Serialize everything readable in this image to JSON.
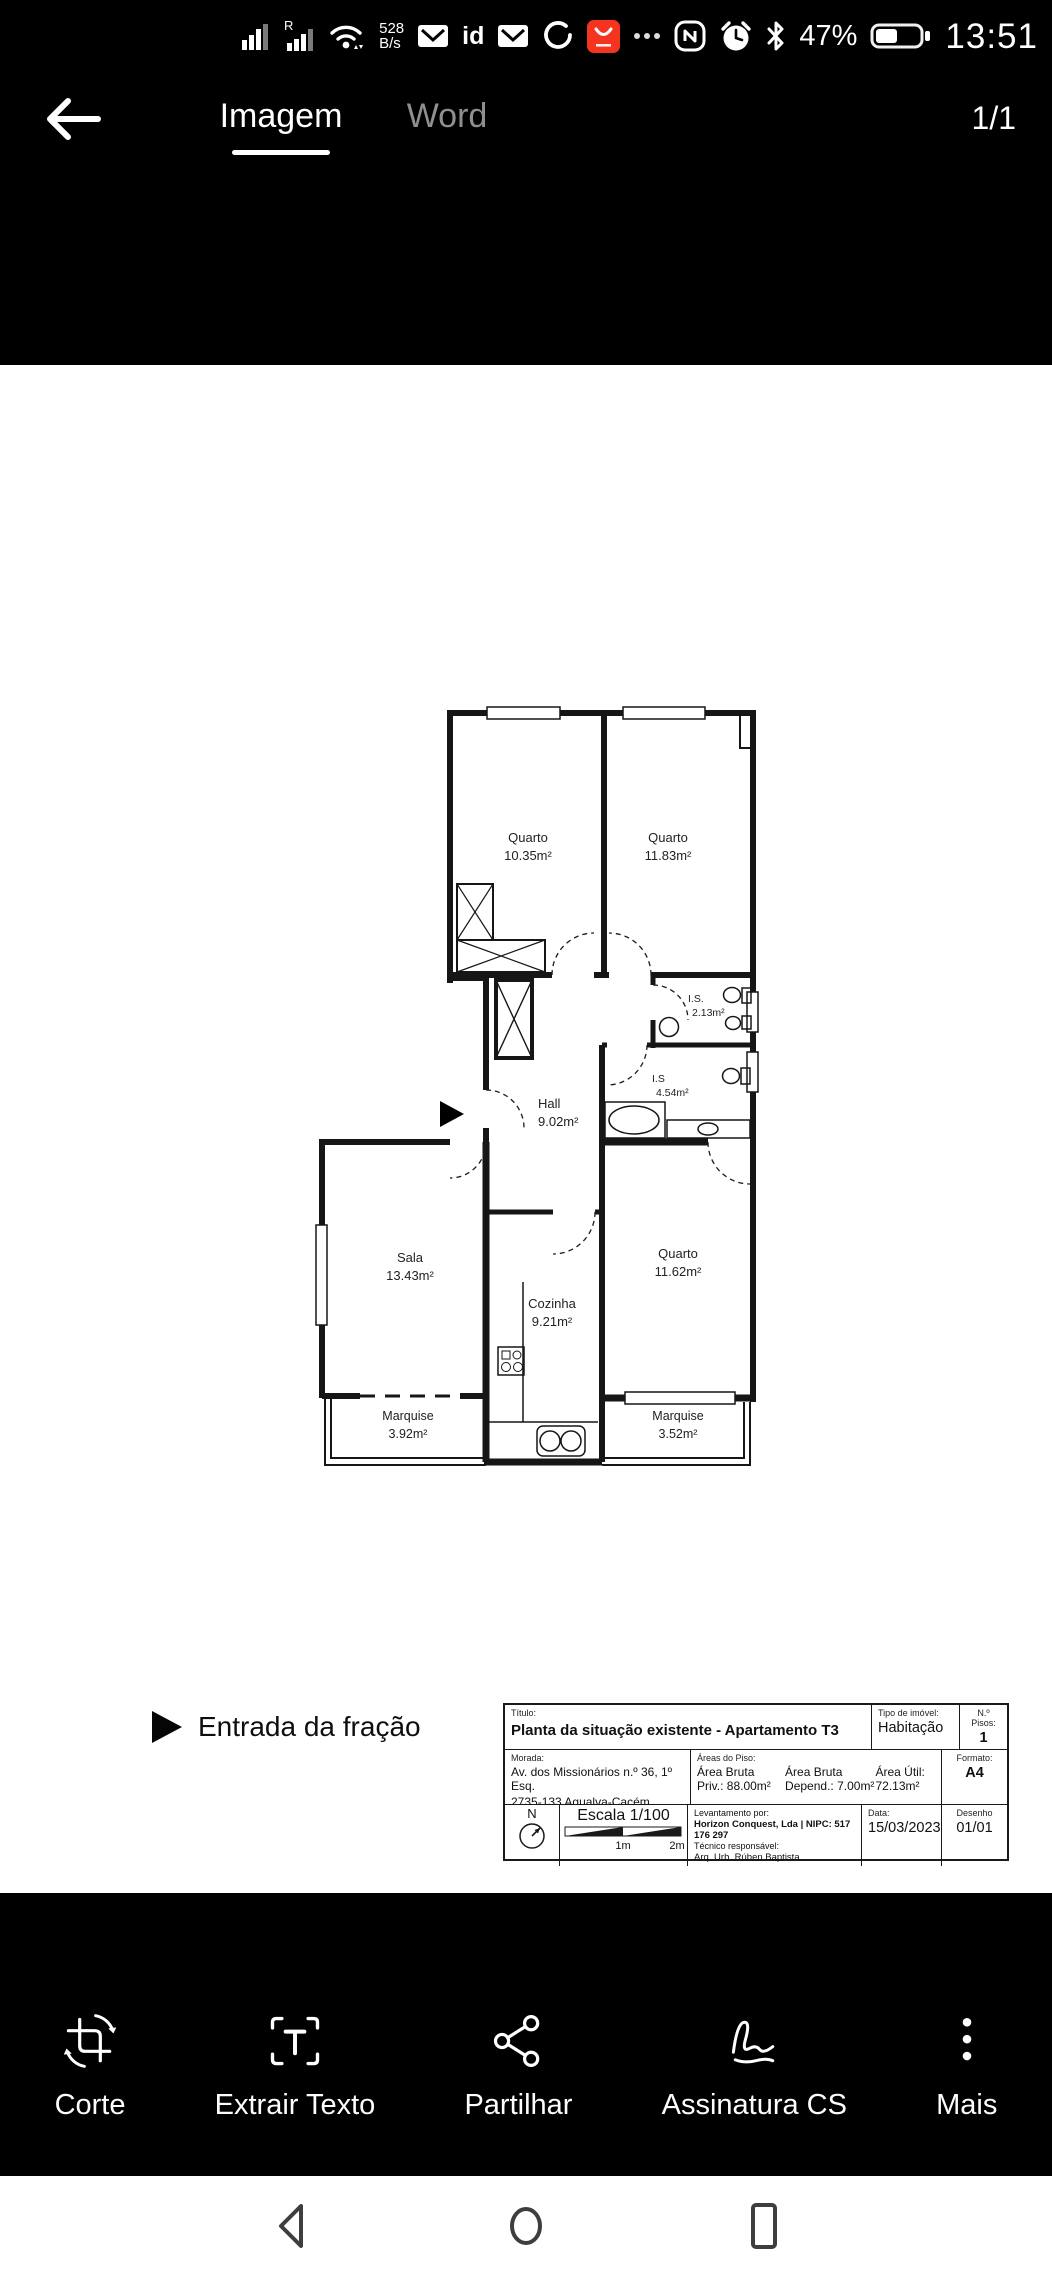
{
  "status_bar": {
    "sim2_badge": "R",
    "network_speed_value": "528",
    "network_speed_unit": "B/s",
    "id_badge": "id",
    "battery_percent": "47%",
    "time": "13:51"
  },
  "header": {
    "tabs": [
      {
        "label": "Imagem",
        "active": true
      },
      {
        "label": "Word",
        "active": false
      }
    ],
    "page_indicator": "1/1"
  },
  "document": {
    "floor_plan": {
      "rooms": [
        {
          "name": "Quarto",
          "area": "10.35m²"
        },
        {
          "name": "Quarto",
          "area": "11.83m²"
        },
        {
          "name": "I.S.",
          "area": "2.13m²"
        },
        {
          "name": "I.S",
          "area": "4.54m²"
        },
        {
          "name": "Hall",
          "area": "9.02m²"
        },
        {
          "name": "Sala",
          "area": "13.43m²"
        },
        {
          "name": "Cozinha",
          "area": "9.21m²"
        },
        {
          "name": "Quarto",
          "area": "11.62m²"
        },
        {
          "name": "Marquise",
          "area": "3.92m²"
        },
        {
          "name": "Marquise",
          "area": "3.52m²"
        }
      ],
      "entrance_legend": "Entrada da fração",
      "title_block": {
        "title_label": "Título:",
        "title": "Planta da situação existente - Apartamento T3",
        "property_type_label": "Tipo de imóvel:",
        "property_type": "Habitação",
        "floors_label": "N.º Pisos:",
        "floors": "1",
        "address_label": "Morada:",
        "address_line1": "Av. dos Missionários n.º 36, 1º Esq.",
        "address_line2": "2735-133 Agualva-Cacém, Sintra",
        "areas_label": "Áreas do Piso:",
        "gross_private_l1": "Área Bruta",
        "gross_private_l2": "Priv.: 88.00m²",
        "gross_dependent_l1": "Área Bruta",
        "gross_dependent_l2": "Depend.: 7.00m²",
        "net_area_l1": "Área Útil:",
        "net_area_l2": "72.13m²",
        "format_label": "Formato:",
        "format": "A4",
        "north_letter": "N",
        "scale": "Escala 1/100",
        "scale_tick_1": "1m",
        "scale_tick_2": "2m",
        "survey_label": "Levantamento por:",
        "survey_company": "Horizon Conquest, Lda | NIPC: 517 176 297",
        "survey_tech_label": "Técnico responsável:",
        "survey_tech": "Arq. Urb. Rúben Baptista",
        "date_label": "Data:",
        "date": "15/03/2023",
        "drawing_label": "Desenho",
        "drawing": "01/01"
      }
    }
  },
  "toolbar": {
    "items": [
      {
        "label": "Corte",
        "icon": "crop-rotate-icon"
      },
      {
        "label": "Extrair Texto",
        "icon": "extract-text-icon"
      },
      {
        "label": "Partilhar",
        "icon": "share-icon"
      },
      {
        "label": "Assinatura CS",
        "icon": "signature-icon"
      },
      {
        "label": "Mais",
        "icon": "more-dots-icon"
      }
    ]
  },
  "nav_bar": {
    "items": [
      "back",
      "home",
      "recents"
    ]
  }
}
